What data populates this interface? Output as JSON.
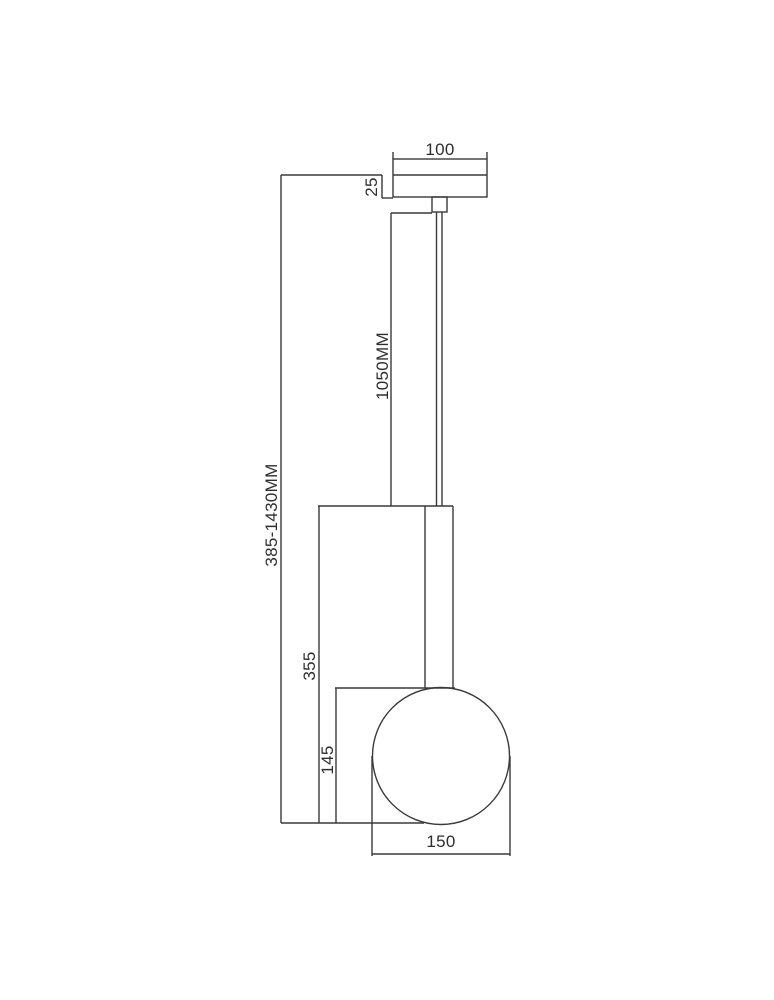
{
  "drawing": {
    "background": "#ffffff",
    "line_color": "#3a3a3a",
    "text_color": "#2e2e2e",
    "labels": {
      "canopy_width": "100",
      "canopy_height": "25",
      "cord_length": "1050MM",
      "overall_height_range": "385-1430MM",
      "body_height": "355",
      "globe_overlap_height": "145",
      "globe_diameter": "150"
    }
  }
}
